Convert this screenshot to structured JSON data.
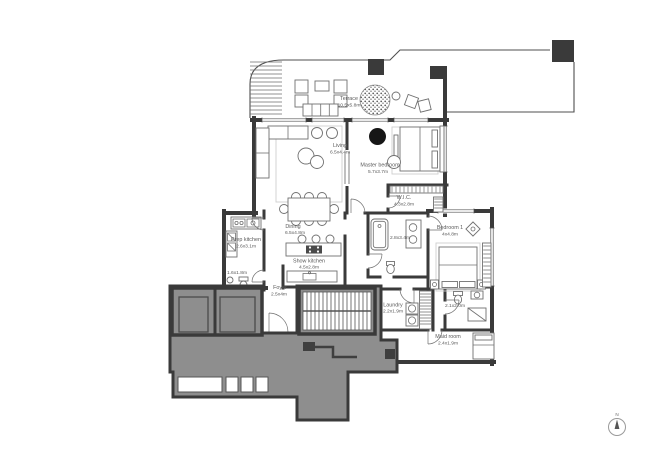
{
  "plan_title": "Apartment floor plan",
  "colors": {
    "wall": "#3a3a3a",
    "core_fill": "#8e8e8e",
    "line": "#4f4f4f",
    "text": "#5a5a5a",
    "background": "#ffffff"
  },
  "rooms": {
    "terrace": {
      "name": "Terrace",
      "dims": "10.5x5.8m"
    },
    "living": {
      "name": "Living",
      "dims": "6.5x4.4m"
    },
    "master_bedroom": {
      "name": "Master bedroom",
      "dims": "5.7x3.7m"
    },
    "wic": {
      "name": "W.I.C.",
      "dims": "4.3x2.8m"
    },
    "master_bath": {
      "dims": "2.8x3.4m"
    },
    "dining": {
      "name": "Dining",
      "dims": "6.5x4.8m"
    },
    "show_kitchen": {
      "name": "Show kitchen",
      "dims": "4.5x2.8m"
    },
    "prep_kitchen": {
      "name": "Prep kitchen",
      "dims": "2.6x3.1m"
    },
    "powder_room": {
      "dims": "1.6x1.8m"
    },
    "foyer": {
      "name": "Foyer",
      "dims": "2.5x4m"
    },
    "bedroom_1": {
      "name": "Bedroom 1",
      "dims": "4x4.8m"
    },
    "laundry": {
      "name": "Laundry",
      "dims": "2.2x1.9m"
    },
    "bathroom_2": {
      "dims": "2.1x2.0m"
    },
    "maid_room": {
      "name": "Maid room",
      "dims": "2.4x1.9m"
    }
  },
  "compass": {
    "label": "N"
  }
}
